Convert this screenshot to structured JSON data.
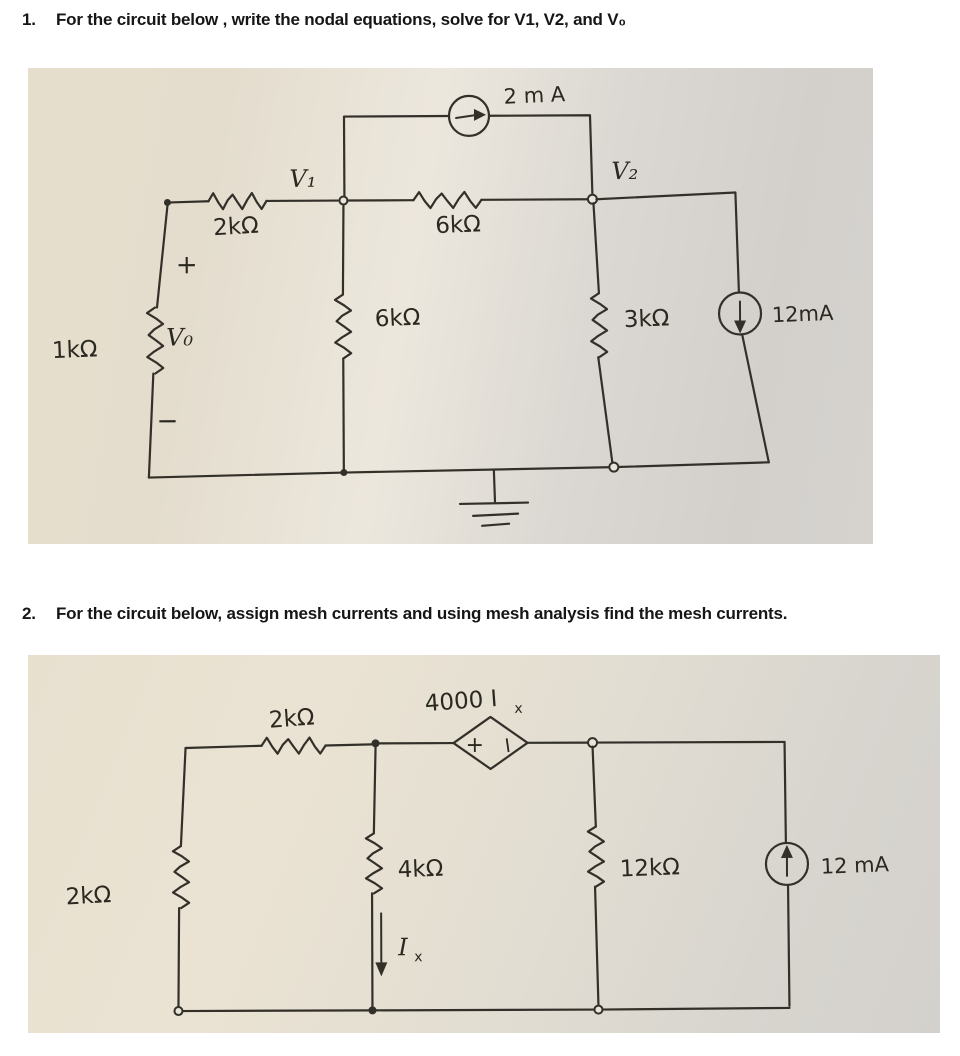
{
  "doc": {
    "questions": [
      {
        "number": "1.",
        "text": "For the circuit below , write the nodal equations, solve for V1, V2, and V₀"
      },
      {
        "number": "2.",
        "text": "For the circuit below, assign mesh currents and using mesh analysis find the mesh currents."
      }
    ]
  },
  "circuit1": {
    "top_source_label": "2 m A",
    "node_v1": "V₁",
    "node_v2": "V₂",
    "r2k": "2kΩ",
    "r6k_top": "6kΩ",
    "r6k_mid": "6kΩ",
    "r3k": "3kΩ",
    "r1k": "1kΩ",
    "vo": "V₀",
    "vo_plus": "+",
    "vo_minus": "−",
    "right_source_label": "12mA"
  },
  "circuit2": {
    "r2k_top": "2kΩ",
    "dep_source_main": "4000 I",
    "dep_source_sub": "x",
    "dep_plus": "+",
    "dep_minus": "−",
    "r2k_left": "2kΩ",
    "r4k": "4kΩ",
    "ix_main": "I",
    "ix_sub": "x",
    "r12k": "12kΩ",
    "right_source_label": "12 mA"
  }
}
